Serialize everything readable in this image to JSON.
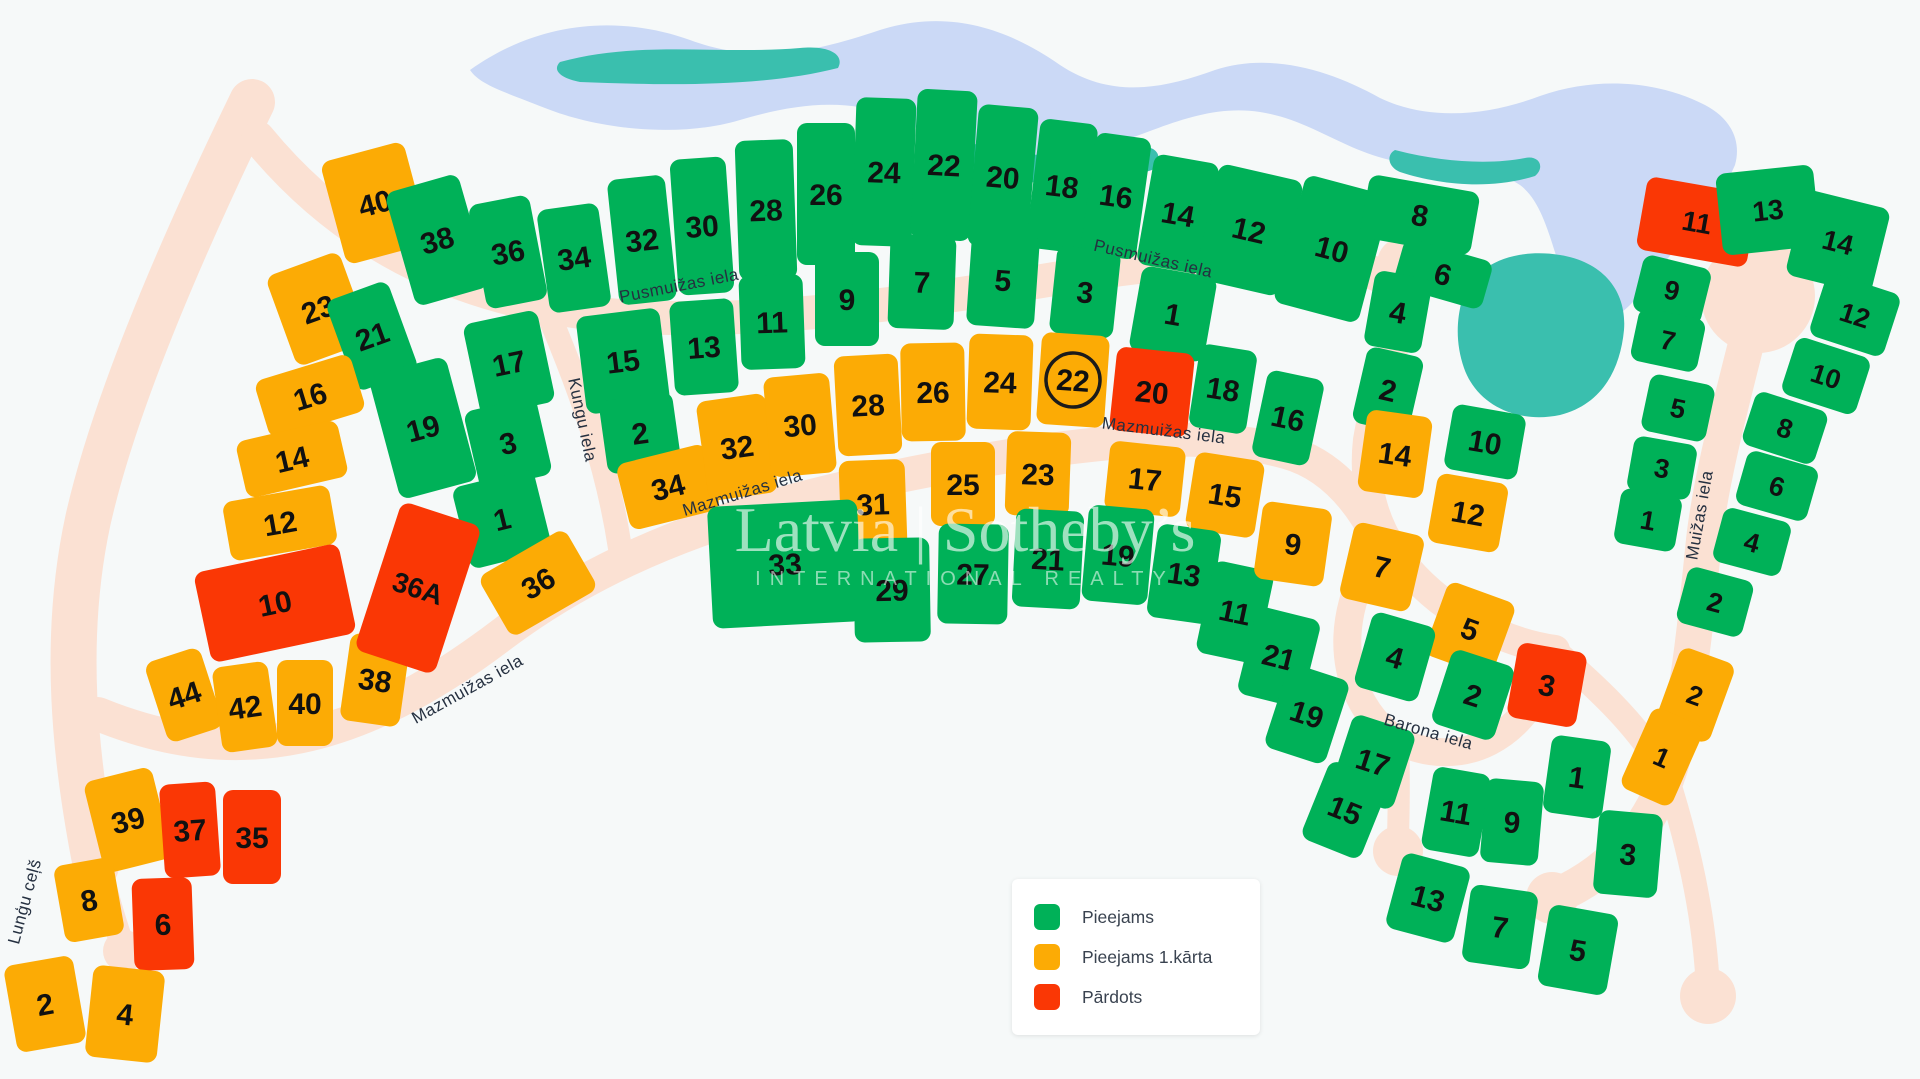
{
  "title": "Land plot availability map",
  "colors": {
    "available": "#00b158",
    "phase1": "#fcab05",
    "sold": "#fa3705",
    "road": "#fbe1d3",
    "lake": "#cbd9f6",
    "pond": "#3abfae",
    "background": "#f6f9f9",
    "lot_number_text": "#111111",
    "street_text": "#253040",
    "legend_text": "#3a4350"
  },
  "legend": {
    "items": [
      {
        "label": "Pieejams",
        "status": "available"
      },
      {
        "label": "Pieejams 1.kārta",
        "status": "phase1"
      },
      {
        "label": "Pārdots",
        "status": "sold"
      }
    ]
  },
  "watermark": {
    "line1": "Latvia | Sotheby’s",
    "line2": "INTERNATIONAL REALTY"
  },
  "streets": [
    {
      "name": "Pusmuižas iela",
      "x": 680,
      "y": 291,
      "rot": -11
    },
    {
      "name": "Pusmuižas iela",
      "x": 1152,
      "y": 264,
      "rot": 13
    },
    {
      "name": "Kungu iela",
      "x": 577,
      "y": 421,
      "rot": 78
    },
    {
      "name": "Mazmuižas iela",
      "x": 470,
      "y": 694,
      "rot": -29
    },
    {
      "name": "Mazmuižas iela",
      "x": 744,
      "y": 498,
      "rot": -17
    },
    {
      "name": "Mazmuižas iela",
      "x": 1163,
      "y": 436,
      "rot": 7
    },
    {
      "name": "Barona iela",
      "x": 1427,
      "y": 737,
      "rot": 16
    },
    {
      "name": "Muižas iela",
      "x": 1705,
      "y": 516,
      "rot": -80
    },
    {
      "name": "Lunģu ceļš",
      "x": 30,
      "y": 903,
      "rot": -75
    }
  ],
  "lots": [
    {
      "n": "40",
      "st": "phase1",
      "x": 375,
      "y": 203,
      "w": 86,
      "h": 106,
      "r": -15
    },
    {
      "n": "38",
      "st": "available",
      "x": 437,
      "y": 240,
      "w": 76,
      "h": 118,
      "r": -16
    },
    {
      "n": "36",
      "st": "available",
      "x": 508,
      "y": 252,
      "w": 62,
      "h": 106,
      "r": -11
    },
    {
      "n": "34",
      "st": "available",
      "x": 574,
      "y": 258,
      "w": 62,
      "h": 104,
      "r": -8
    },
    {
      "n": "32",
      "st": "available",
      "x": 642,
      "y": 240,
      "w": 58,
      "h": 126,
      "r": -6
    },
    {
      "n": "30",
      "st": "available",
      "x": 702,
      "y": 226,
      "w": 56,
      "h": 136,
      "r": -4
    },
    {
      "n": "28",
      "st": "available",
      "x": 766,
      "y": 210,
      "w": 58,
      "h": 140,
      "r": -2
    },
    {
      "n": "26",
      "st": "available",
      "x": 826,
      "y": 194,
      "w": 58,
      "h": 142,
      "r": 0
    },
    {
      "n": "24",
      "st": "available",
      "x": 884,
      "y": 172,
      "w": 60,
      "h": 148,
      "r": 2
    },
    {
      "n": "22",
      "st": "available",
      "x": 944,
      "y": 165,
      "w": 60,
      "h": 150,
      "r": 3
    },
    {
      "n": "20",
      "st": "available",
      "x": 1003,
      "y": 177,
      "w": 60,
      "h": 142,
      "r": 5
    },
    {
      "n": "18",
      "st": "available",
      "x": 1062,
      "y": 186,
      "w": 58,
      "h": 130,
      "r": 7
    },
    {
      "n": "16",
      "st": "available",
      "x": 1116,
      "y": 196,
      "w": 56,
      "h": 122,
      "r": 8
    },
    {
      "n": "14",
      "st": "available",
      "x": 1178,
      "y": 214,
      "w": 66,
      "h": 112,
      "r": 10
    },
    {
      "n": "12",
      "st": "available",
      "x": 1249,
      "y": 230,
      "w": 86,
      "h": 118,
      "r": 13
    },
    {
      "n": "10",
      "st": "available",
      "x": 1332,
      "y": 249,
      "w": 88,
      "h": 132,
      "r": 15
    },
    {
      "n": "8",
      "st": "available",
      "x": 1420,
      "y": 215,
      "w": 112,
      "h": 64,
      "r": 10
    },
    {
      "n": "6",
      "st": "available",
      "x": 1443,
      "y": 274,
      "w": 92,
      "h": 50,
      "r": 16
    },
    {
      "n": "23",
      "st": "phase1",
      "x": 318,
      "y": 309,
      "w": 78,
      "h": 96,
      "r": -20
    },
    {
      "n": "21",
      "st": "available",
      "x": 372,
      "y": 336,
      "w": 66,
      "h": 96,
      "r": -20
    },
    {
      "n": "16",
      "st": "phase1",
      "x": 310,
      "y": 396,
      "w": 100,
      "h": 60,
      "r": -17
    },
    {
      "n": "14",
      "st": "phase1",
      "x": 292,
      "y": 459,
      "w": 104,
      "h": 58,
      "r": -13
    },
    {
      "n": "12",
      "st": "phase1",
      "x": 280,
      "y": 523,
      "w": 108,
      "h": 60,
      "r": -10
    },
    {
      "n": "19",
      "st": "available",
      "x": 423,
      "y": 428,
      "w": 80,
      "h": 128,
      "r": -15
    },
    {
      "n": "17",
      "st": "available",
      "x": 509,
      "y": 363,
      "w": 76,
      "h": 94,
      "r": -12
    },
    {
      "n": "3",
      "st": "available",
      "x": 508,
      "y": 443,
      "w": 74,
      "h": 80,
      "r": -13
    },
    {
      "n": "1",
      "st": "available",
      "x": 502,
      "y": 519,
      "w": 84,
      "h": 84,
      "r": -14
    },
    {
      "n": "15",
      "st": "available",
      "x": 623,
      "y": 361,
      "w": 84,
      "h": 98,
      "r": -7
    },
    {
      "n": "2",
      "st": "available",
      "x": 640,
      "y": 433,
      "w": 74,
      "h": 74,
      "r": -8
    },
    {
      "n": "13",
      "st": "available",
      "x": 704,
      "y": 347,
      "w": 64,
      "h": 94,
      "r": -4
    },
    {
      "n": "11",
      "st": "available",
      "x": 772,
      "y": 322,
      "w": 64,
      "h": 94,
      "r": -2
    },
    {
      "n": "9",
      "st": "available",
      "x": 847,
      "y": 299,
      "w": 64,
      "h": 94,
      "r": 0
    },
    {
      "n": "7",
      "st": "available",
      "x": 922,
      "y": 282,
      "w": 66,
      "h": 94,
      "r": 2
    },
    {
      "n": "5",
      "st": "available",
      "x": 1003,
      "y": 280,
      "w": 68,
      "h": 94,
      "r": 4
    },
    {
      "n": "3",
      "st": "available",
      "x": 1085,
      "y": 292,
      "w": 64,
      "h": 88,
      "r": 6
    },
    {
      "n": "1",
      "st": "available",
      "x": 1173,
      "y": 314,
      "w": 76,
      "h": 86,
      "r": 10
    },
    {
      "n": "18",
      "st": "available",
      "x": 1223,
      "y": 389,
      "w": 58,
      "h": 84,
      "r": 9
    },
    {
      "n": "16",
      "st": "available",
      "x": 1288,
      "y": 418,
      "w": 58,
      "h": 88,
      "r": 12
    },
    {
      "n": "34",
      "st": "phase1",
      "x": 668,
      "y": 487,
      "w": 92,
      "h": 68,
      "r": -14
    },
    {
      "n": "32",
      "st": "phase1",
      "x": 737,
      "y": 447,
      "w": 70,
      "h": 100,
      "r": -8
    },
    {
      "n": "30",
      "st": "phase1",
      "x": 800,
      "y": 425,
      "w": 66,
      "h": 100,
      "r": -5
    },
    {
      "n": "28",
      "st": "phase1",
      "x": 868,
      "y": 405,
      "w": 64,
      "h": 100,
      "r": -3
    },
    {
      "n": "26",
      "st": "phase1",
      "x": 933,
      "y": 392,
      "w": 64,
      "h": 98,
      "r": -1
    },
    {
      "n": "24",
      "st": "phase1",
      "x": 1000,
      "y": 382,
      "w": 64,
      "h": 95,
      "r": 2
    },
    {
      "n": "22",
      "st": "phase1",
      "x": 1073,
      "y": 380,
      "w": 68,
      "h": 92,
      "r": 4,
      "circled": true
    },
    {
      "n": "20",
      "st": "sold",
      "x": 1152,
      "y": 392,
      "w": 78,
      "h": 84,
      "r": 6
    },
    {
      "n": "31",
      "st": "phase1",
      "x": 873,
      "y": 504,
      "w": 66,
      "h": 88,
      "r": -2
    },
    {
      "n": "25",
      "st": "phase1",
      "x": 963,
      "y": 484,
      "w": 64,
      "h": 84,
      "r": 0
    },
    {
      "n": "23",
      "st": "phase1",
      "x": 1038,
      "y": 474,
      "w": 64,
      "h": 84,
      "r": 2
    },
    {
      "n": "17",
      "st": "phase1",
      "x": 1145,
      "y": 479,
      "w": 76,
      "h": 70,
      "r": 6
    },
    {
      "n": "15",
      "st": "phase1",
      "x": 1225,
      "y": 495,
      "w": 70,
      "h": 78,
      "r": 9
    },
    {
      "n": "33",
      "st": "available",
      "x": 785,
      "y": 564,
      "w": 150,
      "h": 122,
      "r": -3
    },
    {
      "n": "29",
      "st": "available",
      "x": 892,
      "y": 590,
      "w": 76,
      "h": 104,
      "r": -1
    },
    {
      "n": "27",
      "st": "available",
      "x": 973,
      "y": 574,
      "w": 70,
      "h": 100,
      "r": 1
    },
    {
      "n": "21",
      "st": "available",
      "x": 1048,
      "y": 559,
      "w": 68,
      "h": 98,
      "r": 3
    },
    {
      "n": "19",
      "st": "available",
      "x": 1118,
      "y": 555,
      "w": 66,
      "h": 96,
      "r": 5
    },
    {
      "n": "13",
      "st": "available",
      "x": 1184,
      "y": 574,
      "w": 64,
      "h": 94,
      "r": 8
    },
    {
      "n": "11",
      "st": "available",
      "x": 1235,
      "y": 612,
      "w": 62,
      "h": 94,
      "r": 12
    },
    {
      "n": "4",
      "st": "available",
      "x": 1398,
      "y": 312,
      "w": 58,
      "h": 76,
      "r": 10
    },
    {
      "n": "2",
      "st": "available",
      "x": 1388,
      "y": 390,
      "w": 58,
      "h": 78,
      "r": 13
    },
    {
      "n": "10",
      "st": "available",
      "x": 1485,
      "y": 442,
      "w": 74,
      "h": 66,
      "r": 10
    },
    {
      "n": "14",
      "st": "phase1",
      "x": 1395,
      "y": 454,
      "w": 66,
      "h": 82,
      "r": 8
    },
    {
      "n": "12",
      "st": "phase1",
      "x": 1468,
      "y": 513,
      "w": 72,
      "h": 70,
      "r": 10
    },
    {
      "n": "9",
      "st": "phase1",
      "x": 1293,
      "y": 544,
      "w": 70,
      "h": 78,
      "r": 8
    },
    {
      "n": "7",
      "st": "phase1",
      "x": 1382,
      "y": 567,
      "w": 72,
      "h": 78,
      "r": 13
    },
    {
      "n": "5",
      "st": "phase1",
      "x": 1470,
      "y": 629,
      "w": 72,
      "h": 78,
      "r": 20
    },
    {
      "n": "21",
      "st": "available",
      "x": 1279,
      "y": 657,
      "w": 66,
      "h": 90,
      "r": 14
    },
    {
      "n": "19",
      "st": "available",
      "x": 1307,
      "y": 714,
      "w": 64,
      "h": 88,
      "r": 18
    },
    {
      "n": "17",
      "st": "available",
      "x": 1373,
      "y": 762,
      "w": 66,
      "h": 82,
      "r": 18
    },
    {
      "n": "15",
      "st": "available",
      "x": 1345,
      "y": 810,
      "w": 64,
      "h": 84,
      "r": 22
    },
    {
      "n": "13",
      "st": "available",
      "x": 1428,
      "y": 898,
      "w": 70,
      "h": 78,
      "r": 15
    },
    {
      "n": "11",
      "st": "available",
      "x": 1456,
      "y": 812,
      "w": 58,
      "h": 84,
      "r": 10
    },
    {
      "n": "9",
      "st": "available",
      "x": 1512,
      "y": 822,
      "w": 58,
      "h": 84,
      "r": 5
    },
    {
      "n": "7",
      "st": "available",
      "x": 1500,
      "y": 927,
      "w": 68,
      "h": 78,
      "r": 8
    },
    {
      "n": "5",
      "st": "available",
      "x": 1578,
      "y": 950,
      "w": 70,
      "h": 82,
      "r": 10
    },
    {
      "n": "3",
      "st": "available",
      "x": 1628,
      "y": 854,
      "w": 64,
      "h": 84,
      "r": 5
    },
    {
      "n": "1",
      "st": "available",
      "x": 1577,
      "y": 777,
      "w": 60,
      "h": 78,
      "r": 8
    },
    {
      "n": "4",
      "st": "available",
      "x": 1395,
      "y": 657,
      "w": 66,
      "h": 78,
      "r": 16
    },
    {
      "n": "2",
      "st": "available",
      "x": 1473,
      "y": 695,
      "w": 66,
      "h": 78,
      "r": 18
    },
    {
      "n": "3",
      "st": "sold",
      "x": 1547,
      "y": 685,
      "w": 70,
      "h": 76,
      "r": 10
    },
    {
      "n": "11",
      "st": "sold",
      "x": 1697,
      "y": 222,
      "w": 112,
      "h": 74,
      "r": 10,
      "f": 28
    },
    {
      "n": "13",
      "st": "available",
      "x": 1768,
      "y": 210,
      "w": 98,
      "h": 82,
      "r": -6,
      "f": 28
    },
    {
      "n": "14",
      "st": "available",
      "x": 1838,
      "y": 242,
      "w": 88,
      "h": 88,
      "r": 14,
      "f": 28
    },
    {
      "n": "12",
      "st": "available",
      "x": 1855,
      "y": 315,
      "w": 78,
      "h": 66,
      "r": 18,
      "f": 27
    },
    {
      "n": "10",
      "st": "available",
      "x": 1826,
      "y": 376,
      "w": 78,
      "h": 60,
      "r": 18,
      "f": 27
    },
    {
      "n": "8",
      "st": "available",
      "x": 1785,
      "y": 428,
      "w": 76,
      "h": 56,
      "r": 18,
      "f": 27
    },
    {
      "n": "6",
      "st": "available",
      "x": 1777,
      "y": 486,
      "w": 74,
      "h": 56,
      "r": 16,
      "f": 27
    },
    {
      "n": "4",
      "st": "available",
      "x": 1752,
      "y": 542,
      "w": 70,
      "h": 56,
      "r": 15,
      "f": 27
    },
    {
      "n": "2",
      "st": "available",
      "x": 1715,
      "y": 602,
      "w": 68,
      "h": 58,
      "r": 15,
      "f": 27
    },
    {
      "n": "9",
      "st": "available",
      "x": 1672,
      "y": 290,
      "w": 70,
      "h": 58,
      "r": 14,
      "f": 27
    },
    {
      "n": "7",
      "st": "available",
      "x": 1668,
      "y": 340,
      "w": 68,
      "h": 54,
      "r": 12,
      "f": 27
    },
    {
      "n": "5",
      "st": "available",
      "x": 1678,
      "y": 408,
      "w": 66,
      "h": 58,
      "r": 12,
      "f": 27
    },
    {
      "n": "3",
      "st": "available",
      "x": 1662,
      "y": 468,
      "w": 64,
      "h": 56,
      "r": 10,
      "f": 27
    },
    {
      "n": "1",
      "st": "available",
      "x": 1648,
      "y": 520,
      "w": 62,
      "h": 56,
      "r": 10,
      "f": 27
    },
    {
      "n": "2",
      "st": "phase1",
      "x": 1695,
      "y": 695,
      "w": 58,
      "h": 84,
      "r": 20,
      "f": 27
    },
    {
      "n": "1",
      "st": "phase1",
      "x": 1662,
      "y": 757,
      "w": 56,
      "h": 88,
      "r": 24,
      "f": 27
    },
    {
      "n": "44",
      "st": "phase1",
      "x": 184,
      "y": 695,
      "w": 58,
      "h": 84,
      "r": -18
    },
    {
      "n": "42",
      "st": "phase1",
      "x": 245,
      "y": 707,
      "w": 56,
      "h": 86,
      "r": -8
    },
    {
      "n": "40",
      "st": "phase1",
      "x": 305,
      "y": 703,
      "w": 56,
      "h": 86,
      "r": 0
    },
    {
      "n": "38",
      "st": "phase1",
      "x": 375,
      "y": 680,
      "w": 60,
      "h": 88,
      "r": 8
    },
    {
      "n": "39",
      "st": "phase1",
      "x": 128,
      "y": 820,
      "w": 70,
      "h": 94,
      "r": -14
    },
    {
      "n": "37",
      "st": "sold",
      "x": 190,
      "y": 830,
      "w": 56,
      "h": 94,
      "r": -4
    },
    {
      "n": "35",
      "st": "sold",
      "x": 252,
      "y": 837,
      "w": 58,
      "h": 94,
      "r": 0
    },
    {
      "n": "8",
      "st": "phase1",
      "x": 89,
      "y": 900,
      "w": 60,
      "h": 78,
      "r": -10
    },
    {
      "n": "6",
      "st": "sold",
      "x": 163,
      "y": 924,
      "w": 60,
      "h": 92,
      "r": -2
    },
    {
      "n": "2",
      "st": "phase1",
      "x": 45,
      "y": 1004,
      "w": 70,
      "h": 88,
      "r": -10
    },
    {
      "n": "4",
      "st": "phase1",
      "x": 125,
      "y": 1014,
      "w": 72,
      "h": 92,
      "r": 6
    },
    {
      "n": "10",
      "st": "sold",
      "x": 275,
      "y": 603,
      "w": 148,
      "h": 92,
      "r": -12
    },
    {
      "n": "36A",
      "st": "sold",
      "x": 418,
      "y": 588,
      "w": 84,
      "h": 156,
      "r": 18,
      "f": 28
    },
    {
      "n": "36",
      "st": "phase1",
      "x": 538,
      "y": 583,
      "w": 100,
      "h": 70,
      "r": -30
    }
  ]
}
